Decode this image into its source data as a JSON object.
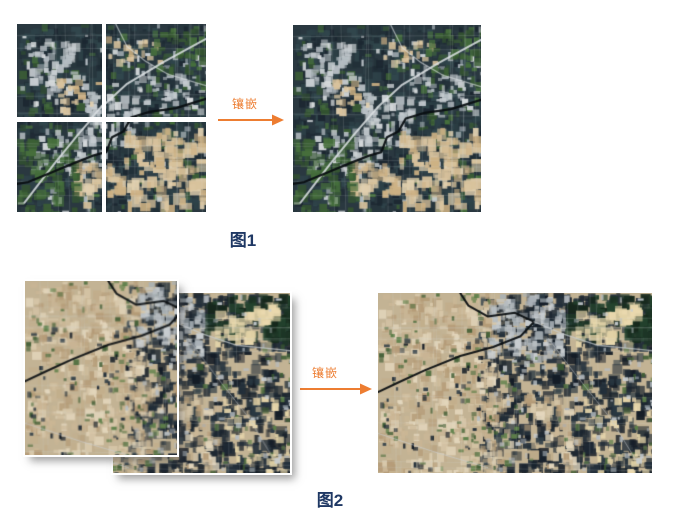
{
  "figure1": {
    "arrow_label": "镶嵌",
    "caption": "图1",
    "description": "four-tile-satellite-mosaic"
  },
  "figure2": {
    "arrow_label": "镶嵌",
    "caption": "图2",
    "description": "two-overlapping-photo-mosaic"
  },
  "colors": {
    "accent_orange": "#ED7D31",
    "caption_navy": "#1F3864",
    "page_background": "#FFFFFF"
  },
  "satellite": {
    "scene1": {
      "base": "#2A3840",
      "dark": [
        "#1B2630",
        "#223038",
        "#2E4248",
        "#31474D",
        "#27363D"
      ],
      "green": [
        "#3C5F35",
        "#466F3C",
        "#335230"
      ],
      "light": [
        "#C6CCD0",
        "#B4BCC2",
        "#D6DADC"
      ],
      "tan": [
        "#D8C29C",
        "#E0CFAE",
        "#CDB184"
      ],
      "river": "#0A0F12",
      "road": "#DDE2E4"
    },
    "scene2": {
      "base": "#C3B394",
      "dark": [
        "#1A242E",
        "#141C26",
        "#232F3A",
        "#2B3A44"
      ],
      "field": [
        "#D8C8AA",
        "#E3D6BC",
        "#CBB796",
        "#C2AE8C",
        "#B59C78"
      ],
      "green": [
        "#4E6E3E",
        "#5D7F49",
        "#3E5C33"
      ],
      "forest": [
        "#1D3526",
        "#24432E",
        "#16281C"
      ],
      "light": [
        "#B6BCC0",
        "#C8CDD0",
        "#A8B0B6"
      ],
      "beige": [
        "#EAD9AE",
        "#E2D2A6"
      ],
      "road": "#0B0F12",
      "lightroad": "#C9CED2"
    }
  }
}
